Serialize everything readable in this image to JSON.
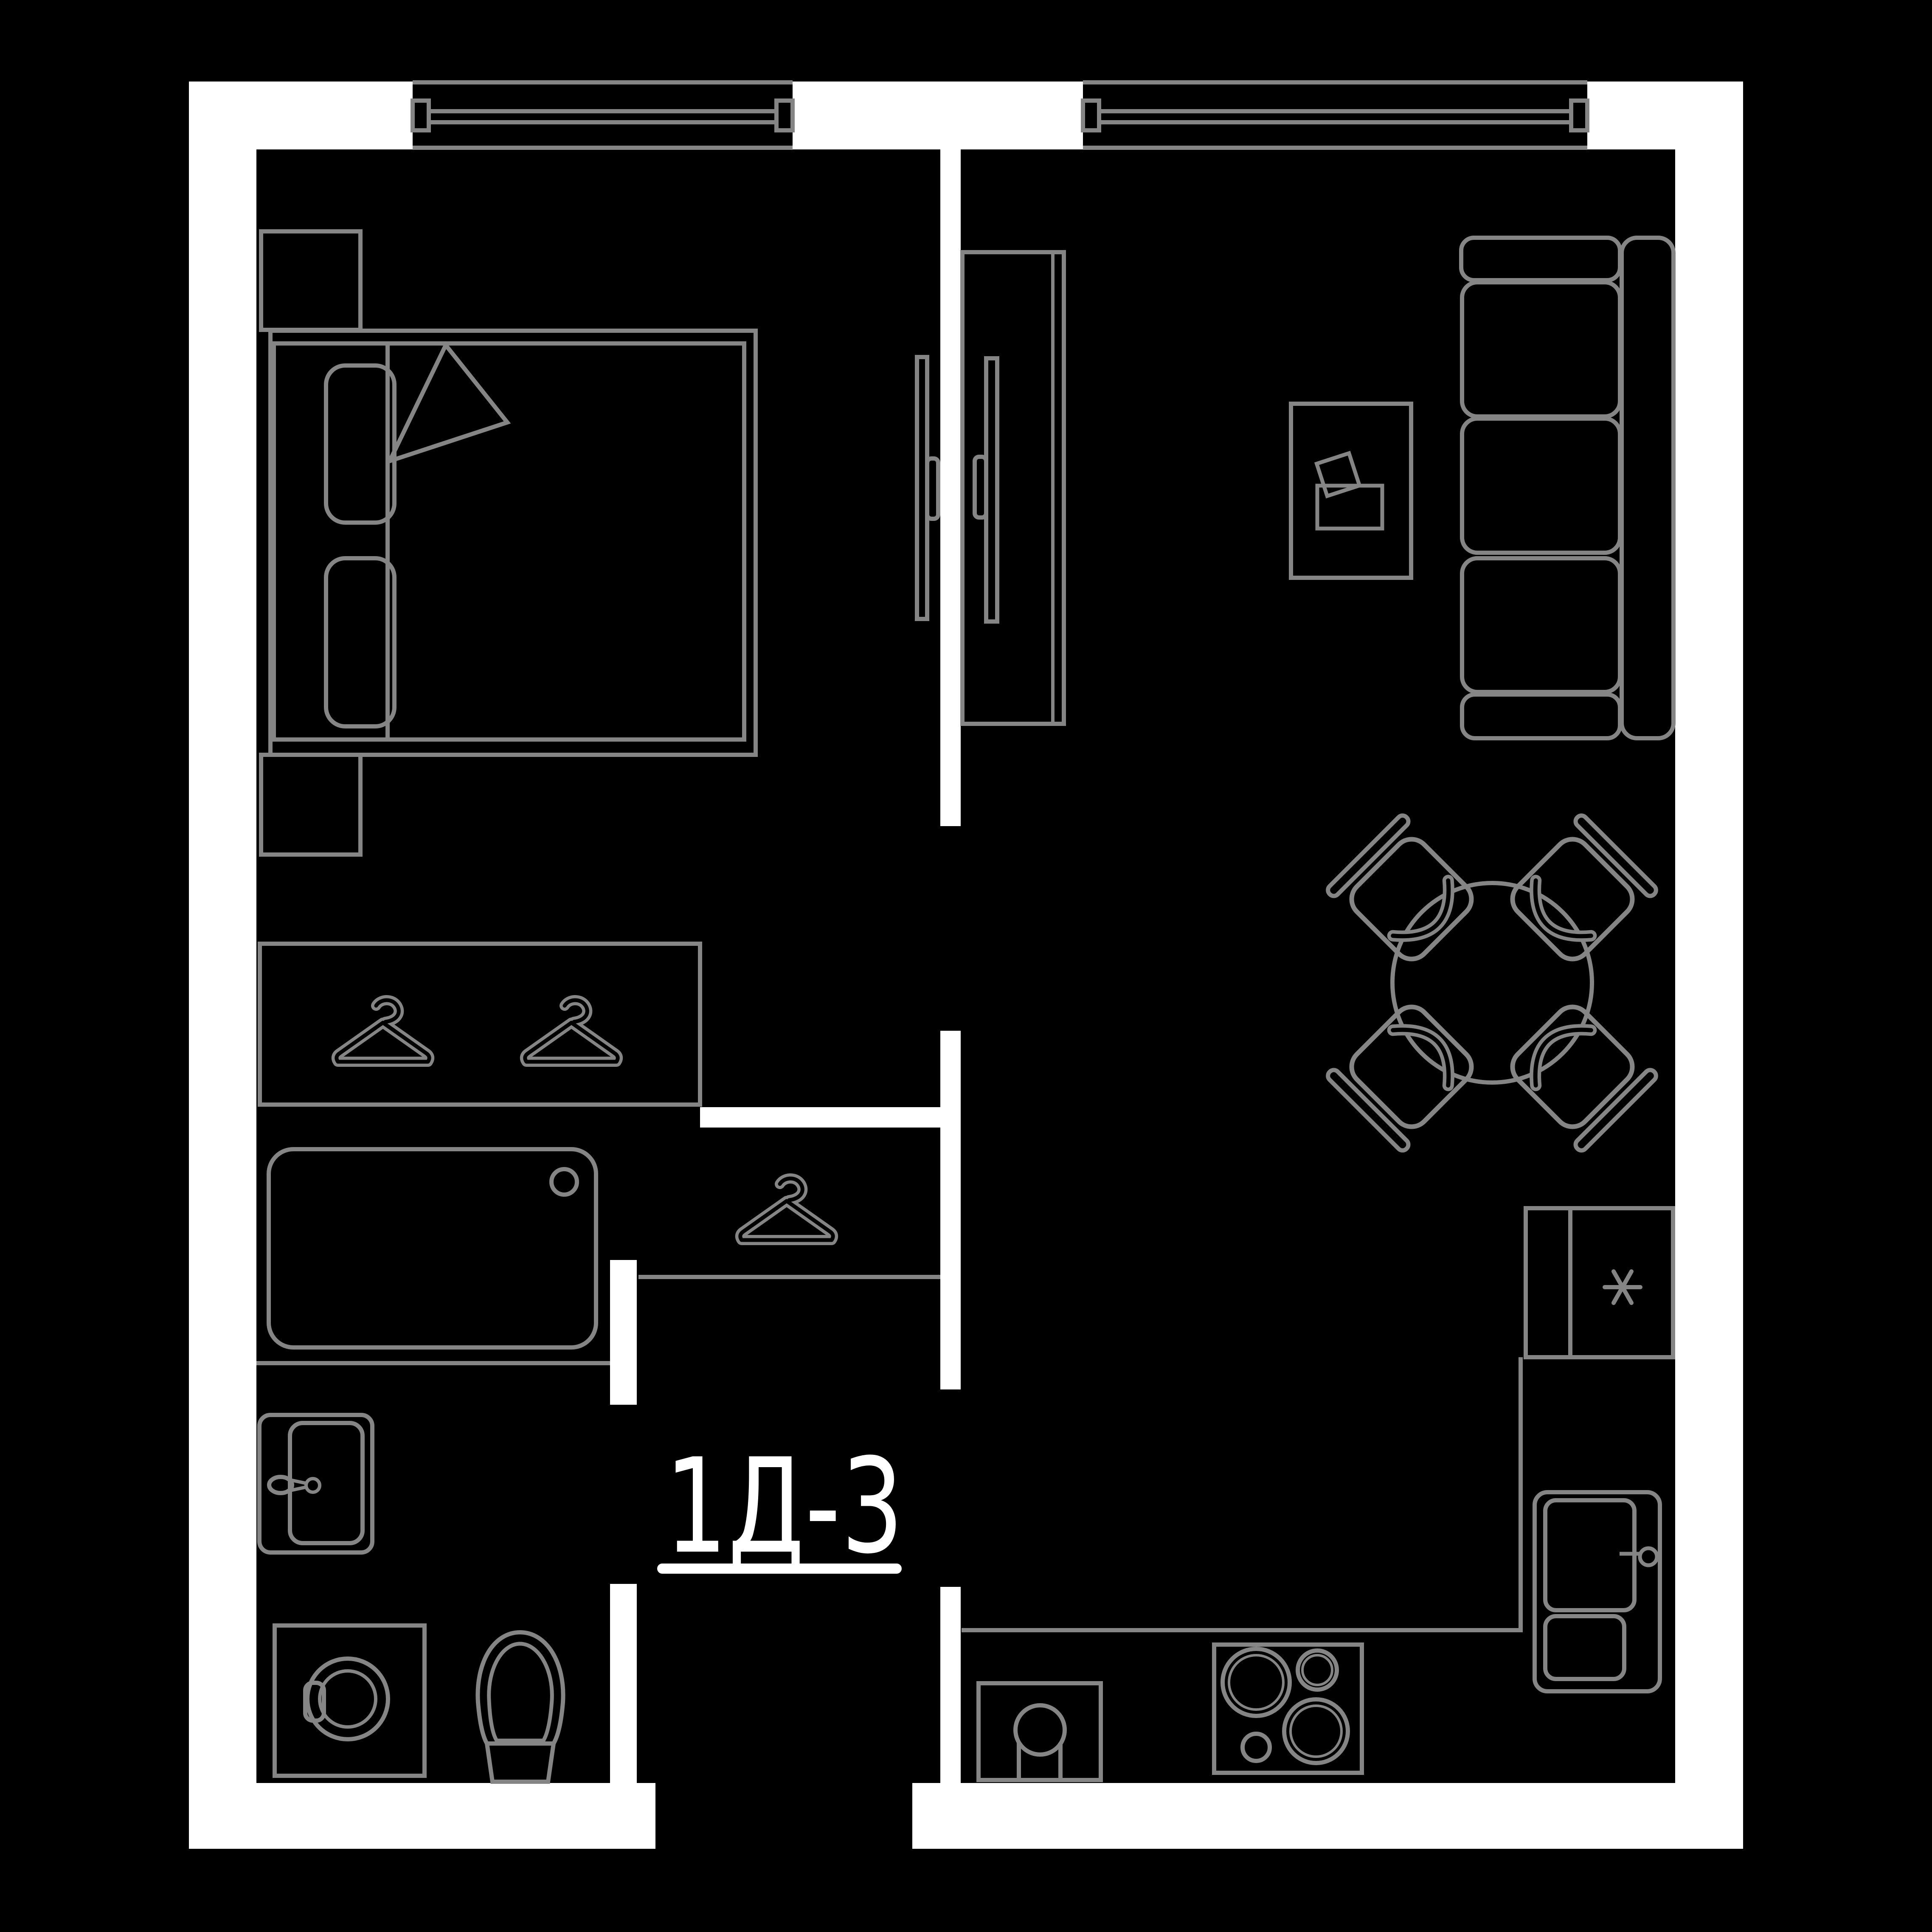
{
  "plan": {
    "label": "1Д-3",
    "type_label_underlined": true
  },
  "colors": {
    "background": "#000000",
    "wall": "#ffffff",
    "line": "#858585",
    "cutout": "#000000",
    "text": "#ffffff"
  },
  "rooms": {
    "bedroom": "bedroom",
    "living_kitchen": "living-room-with-kitchen",
    "bathroom": "bathroom",
    "hallway": "hallway-with-closet"
  },
  "icons": {
    "hanger_wardrobe_left": "hanger-icon",
    "hanger_wardrobe_right": "hanger-icon",
    "hanger_closet": "hanger-icon",
    "fridge_symbol": "asterisk-icon"
  },
  "furniture": [
    "double-bed",
    "pillow",
    "pillow",
    "blanket-fold",
    "nightstand",
    "nightstand",
    "sliding-panel",
    "wardrobe-two-hangers",
    "closet-single-hanger",
    "bathtub",
    "washbasin",
    "washing-machine",
    "toilet",
    "tall-wardrobe",
    "sofa",
    "coffee-table",
    "dining-table",
    "dining-chair",
    "dining-chair",
    "dining-chair",
    "dining-chair",
    "fridge",
    "kitchen-counter",
    "kitchen-cabinet",
    "kitchen-sink",
    "cooktop"
  ]
}
